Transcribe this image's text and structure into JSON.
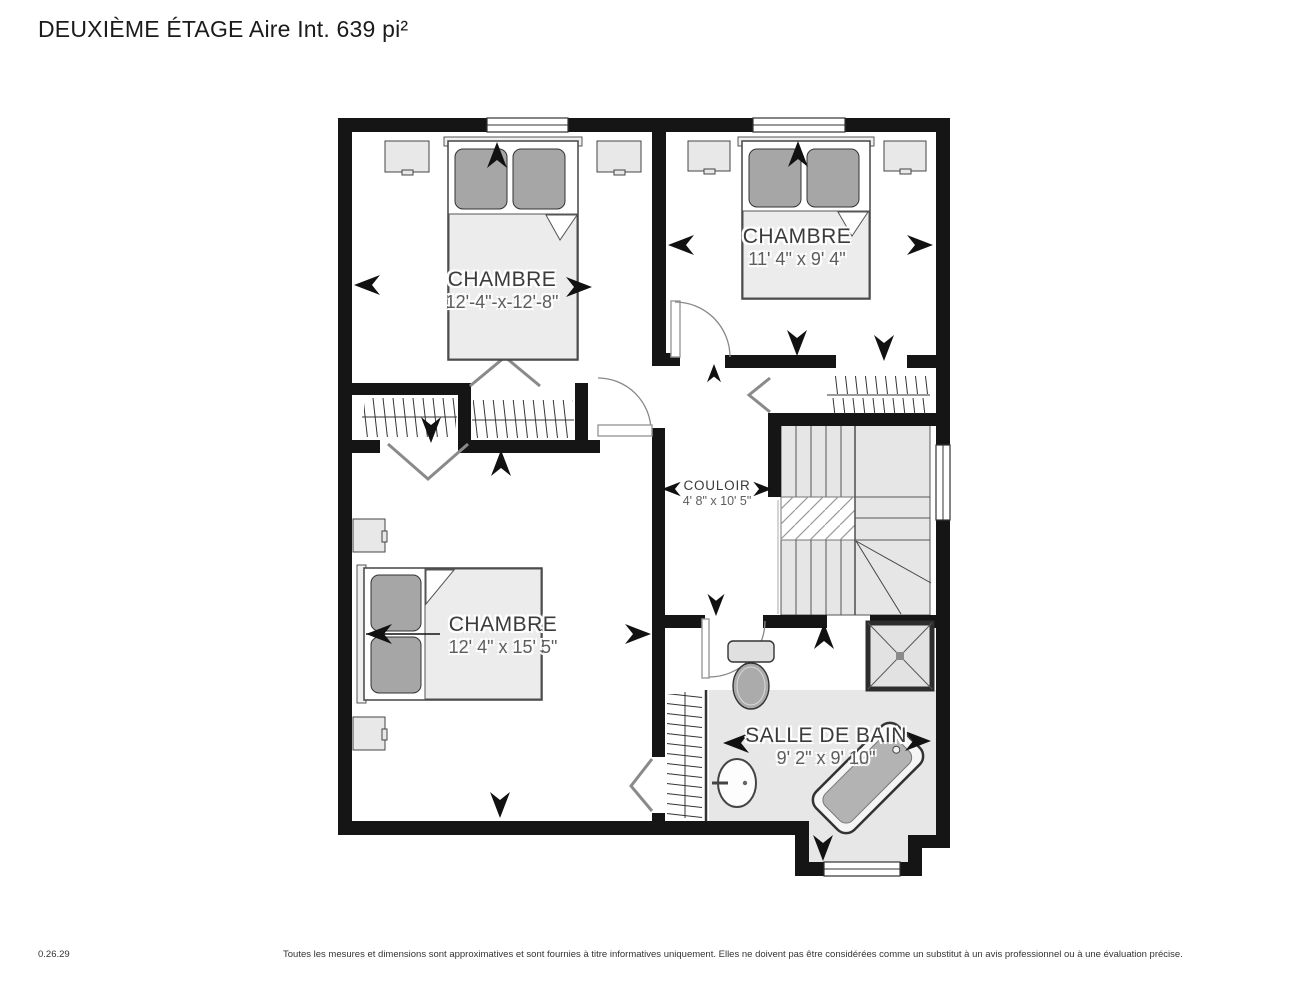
{
  "title": "DEUXIÈME ÉTAGE Aire Int. 639 pi²",
  "rooms": [
    {
      "id": "bedroom-1",
      "name": "CHAMBRE",
      "dimensions": "12'-4\"-x-12'-8\""
    },
    {
      "id": "bedroom-2",
      "name": "CHAMBRE",
      "dimensions": "11' 4\" x 9' 4\""
    },
    {
      "id": "bedroom-3",
      "name": "CHAMBRE",
      "dimensions": "12' 4\" x 15' 5\""
    },
    {
      "id": "hallway",
      "name": "COULOIR",
      "dimensions": "4' 8\" x 10' 5\""
    },
    {
      "id": "bathroom",
      "name": "SALLE DE BAIN",
      "dimensions": "9' 2\" x 9' 10\""
    }
  ],
  "fixtures": [
    "bed-icon",
    "nightstand-icon",
    "toilet-icon",
    "shower-icon",
    "bathtub-icon",
    "sink-icon",
    "stairs-icon",
    "closet-rack-icon",
    "door-arc-icon",
    "window-icon",
    "dimension-arrow-icon",
    "bifold-door-icon"
  ],
  "footer": {
    "version": "0.26.29",
    "disclaimer": "Toutes les mesures et dimensions sont approximatives et sont fournies à titre informatives uniquement. Elles ne doivent pas être considérées comme un substitut à un avis professionnel ou à une évaluation précise."
  },
  "colors": {
    "wall": "#151515",
    "floor": "#ffffff",
    "bathroom_floor": "#e7e7e7",
    "stairs_fill": "#e6e6e6",
    "furniture_fill": "#ececec",
    "pillow_fill": "#a6a6a6",
    "line": "#555555"
  }
}
